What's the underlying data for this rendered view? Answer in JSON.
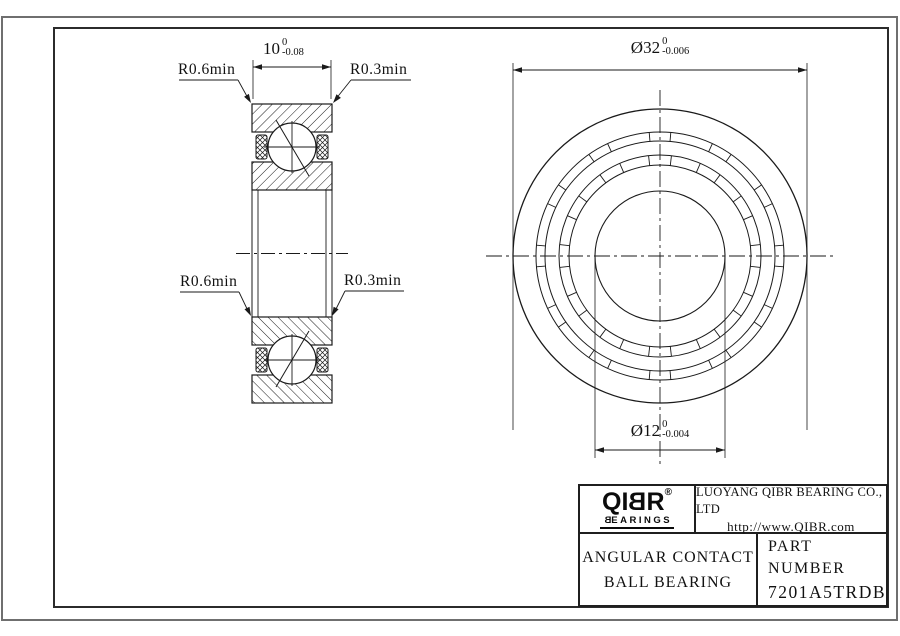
{
  "sheet": {
    "background": "#ffffff",
    "line_color": "#1a1a1a",
    "outer_border_color": "#6f6f6f",
    "frame_color": "#2b2b2b"
  },
  "section_view": {
    "width_dim": {
      "value": "10",
      "tol_upper": "0",
      "tol_lower": "-0.08"
    },
    "radius_min_outer": "R0.6min",
    "radius_min_inner": "R0.3min"
  },
  "front_view": {
    "outer_diameter_dim": {
      "value": "Ø32",
      "tol_upper": "0",
      "tol_lower": "-0.006"
    },
    "bore_diameter_dim": {
      "value": "Ø12",
      "tol_upper": "0",
      "tol_lower": "-0.004"
    }
  },
  "title_block": {
    "logo_part1": "QI",
    "logo_part2": "B",
    "logo_part3": "R",
    "logo_reg": "®",
    "logo_sub_first": "B",
    "logo_sub_rest": "EARINGS",
    "company": "LUOYANG QIBR BEARING CO., LTD",
    "website": "http://www.QIBR.com",
    "product_line1": "ANGULAR CONTACT",
    "product_line2": "BALL BEARING",
    "part_number_label": "PART NUMBER",
    "part_number": "7201A5TRDB"
  }
}
